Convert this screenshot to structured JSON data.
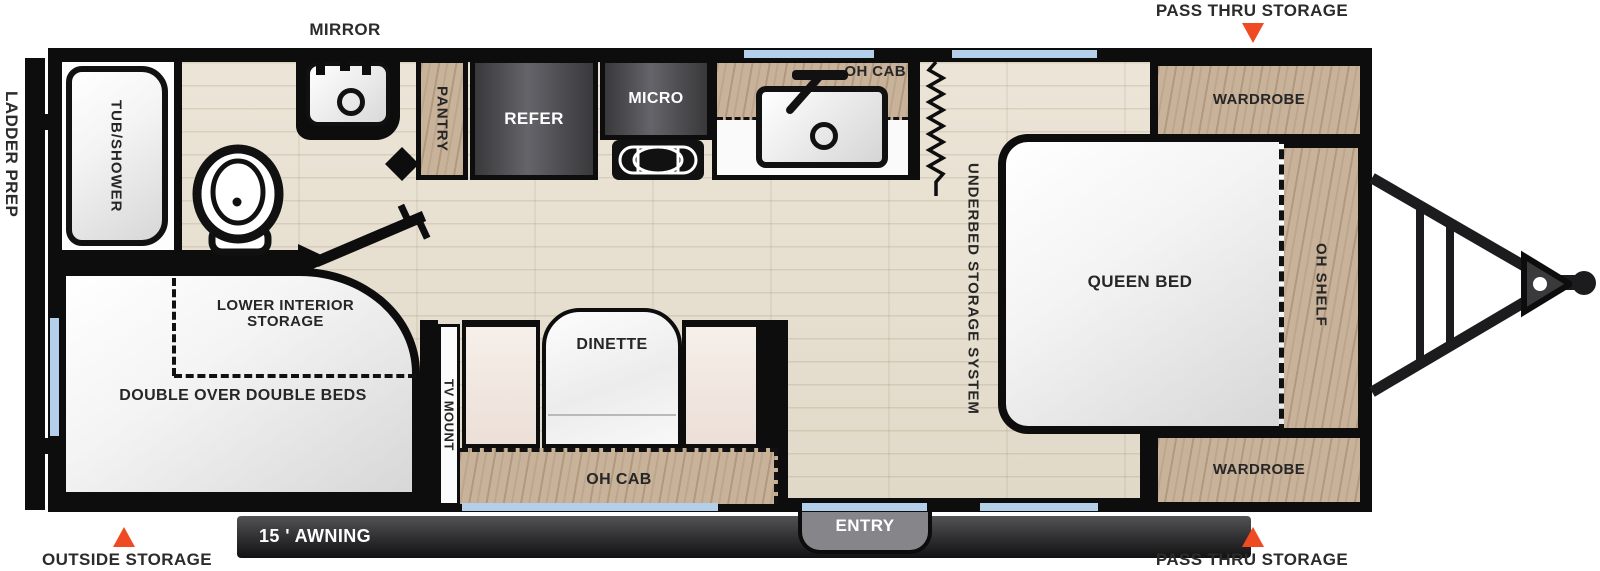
{
  "title": "Travel trailer floor plan",
  "exterior": {
    "mirror": "MIRROR",
    "pass_thru_top": "PASS THRU STORAGE",
    "pass_thru_bottom": "PASS THRU STORAGE",
    "outside_storage": "OUTSIDE STORAGE",
    "ladder_prep": "LADDER PREP",
    "awning": "15 ' AWNING",
    "entry": "ENTRY"
  },
  "rooms": {
    "tub_shower": "TUB/SHOWER",
    "pantry": "PANTRY",
    "refer": "REFER",
    "micro": "MICRO",
    "oh_cab_kitchen": "OH CAB",
    "underbed": "UNDERBED STORAGE SYSTEM",
    "queen_bed": "QUEEN BED",
    "wardrobe_top": "WARDROBE",
    "wardrobe_bottom": "WARDROBE",
    "oh_shelf": "OH SHELF",
    "lower_interior_storage": "LOWER INTERIOR STORAGE",
    "double_beds": "DOUBLE OVER DOUBLE BEDS",
    "tv_mount": "TV MOUNT",
    "dinette": "DINETTE",
    "oh_cab_dinette": "OH CAB"
  },
  "colors": {
    "accent_orange": "#f04a23",
    "window_blue": "#b3cfe9",
    "wall_black": "#0d0d0d",
    "cabinet_wood": "#c8b299",
    "floor_wood": "#e9e2d3",
    "awning_gray": "#39393c",
    "appliance_gray": "#4a4a4e"
  }
}
